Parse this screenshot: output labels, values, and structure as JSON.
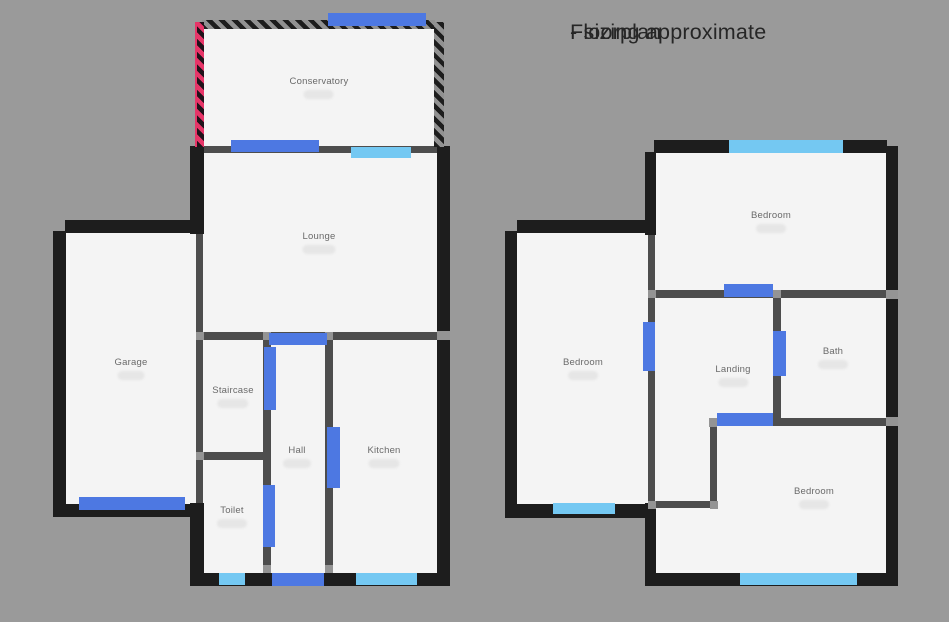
{
  "title": {
    "line1": "Floorplan",
    "line2": "- sizing approximate"
  },
  "colors": {
    "background": "#9a9a9a",
    "room_fill": "#f4f4f4",
    "wall_exterior": "#1d1d1d",
    "wall_interior": "#4d4d4d",
    "wall_connector": "#949494",
    "door": "#4d78e2",
    "window": "#74c8f2",
    "conservatory_wall_pink": "#e73568",
    "label_text": "#6a6a6a",
    "dimension_blob": "#e6e6e6",
    "title_text": "#262626"
  },
  "floors": {
    "ground": {
      "rooms": [
        {
          "label": "Conservatory"
        },
        {
          "label": "Lounge"
        },
        {
          "label": "Garage"
        },
        {
          "label": "Staircase"
        },
        {
          "label": "Hall"
        },
        {
          "label": "Toilet"
        },
        {
          "label": "Kitchen"
        }
      ]
    },
    "first": {
      "rooms": [
        {
          "label": "Bedroom"
        },
        {
          "label": "Bedroom"
        },
        {
          "label": "Landing"
        },
        {
          "label": "Bath"
        },
        {
          "label": "Bedroom"
        }
      ]
    }
  }
}
